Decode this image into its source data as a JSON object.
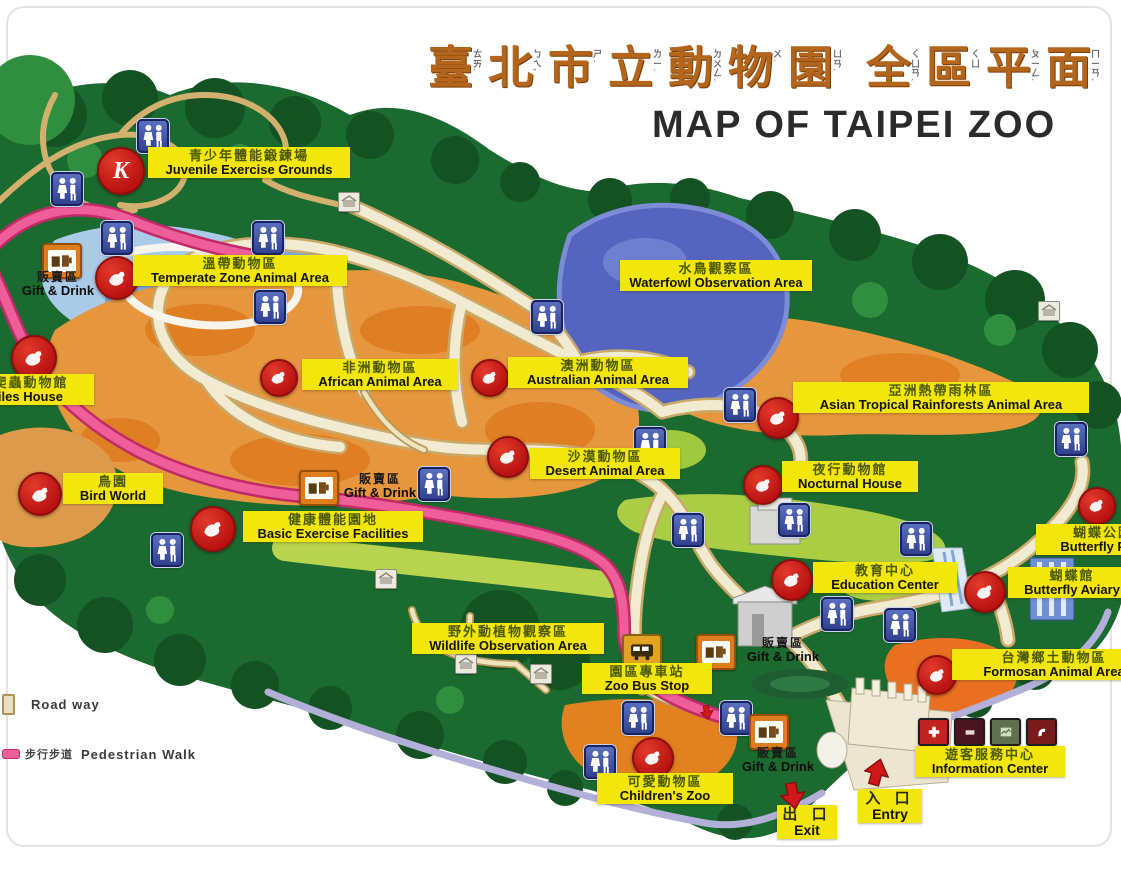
{
  "title": {
    "chars": [
      {
        "c": "臺",
        "z": "ㄊㄞˊ"
      },
      {
        "c": "北",
        "z": "ㄅㄟˇ"
      },
      {
        "c": "市",
        "z": "ㄕˋ"
      },
      {
        "c": "立",
        "z": "ㄌㄧˋ"
      },
      {
        "c": "動",
        "z": "ㄉㄨㄥˋ"
      },
      {
        "c": "物",
        "z": "ㄨˋ"
      },
      {
        "c": "園",
        "z": "ㄩㄢˊ"
      },
      {
        "c": "全",
        "z": "ㄑㄩㄢˊ",
        "gap": true
      },
      {
        "c": "區",
        "z": "ㄑㄩ"
      },
      {
        "c": "平",
        "z": "ㄆㄧㄥˊ"
      },
      {
        "c": "面",
        "z": "ㄇㄧㄢˋ"
      }
    ],
    "en": "MAP OF TAIPEI ZOO"
  },
  "legend": {
    "road_way_en": "Road way",
    "pedestrian_zh": "步行步道",
    "pedestrian_en": "Pedestrian Walk"
  },
  "map": {
    "area_labels": [
      {
        "name": "juvenile-exercise-grounds",
        "zh": "青少年體能鍛鍊場",
        "en": "Juvenile Exercise Grounds",
        "x": 148,
        "y": 147,
        "w": 198
      },
      {
        "name": "temperate-zone-animal-area",
        "zh": "溫帶動物區",
        "en": "Temperate Zone Animal Area",
        "x": 133,
        "y": 255,
        "w": 210
      },
      {
        "name": "waterfowl-observation-area",
        "zh": "水鳥觀察區",
        "en": "Waterfowl Observation Area",
        "x": 620,
        "y": 260,
        "w": 188
      },
      {
        "name": "african-animal-area",
        "zh": "非洲動物區",
        "en": "African Animal Area",
        "x": 302,
        "y": 359,
        "w": 152
      },
      {
        "name": "australian-animal-area",
        "zh": "澳洲動物區",
        "en": "Australian Animal Area",
        "x": 508,
        "y": 357,
        "w": 176
      },
      {
        "name": "asian-tropical-rainforests-animal-area",
        "zh": "亞洲熱帶雨林區",
        "en": "Asian Tropical Rainforests Animal Area",
        "x": 793,
        "y": 382,
        "w": 292
      },
      {
        "name": "desert-animal-area",
        "zh": "沙漠動物區",
        "en": "Desert Animal Area",
        "x": 530,
        "y": 448,
        "w": 146
      },
      {
        "name": "nocturnal-house",
        "zh": "夜行動物館",
        "en": "Nocturnal House",
        "x": 782,
        "y": 461,
        "w": 132
      },
      {
        "name": "reptiles-house",
        "zh": "兩棲爬蟲動物館",
        "en": "Reptiles House",
        "x": -62,
        "y": 374,
        "w": 152
      },
      {
        "name": "bird-world",
        "zh": "鳥園",
        "en": "Bird World",
        "x": 63,
        "y": 473,
        "w": 96
      },
      {
        "name": "basic-exercise-facilities",
        "zh": "健康體能園地",
        "en": "Basic Exercise Facilities",
        "x": 243,
        "y": 511,
        "w": 176
      },
      {
        "name": "butterfly-park",
        "zh": "蝴蝶公園",
        "en": "Butterfly Park",
        "x": 1036,
        "y": 524,
        "w": 130
      },
      {
        "name": "butterfly-aviary",
        "zh": "蝴蝶館",
        "en": "Butterfly Aviary",
        "x": 1008,
        "y": 567,
        "w": 124
      },
      {
        "name": "education-center",
        "zh": "教育中心",
        "en": "Education Center",
        "x": 813,
        "y": 562,
        "w": 140
      },
      {
        "name": "wildlife-observation-area",
        "zh": "野外動植物觀察區",
        "en": "Wildlife Observation Area",
        "x": 412,
        "y": 623,
        "w": 188
      },
      {
        "name": "zoo-bus-stop",
        "zh": "園區專車站",
        "en": "Zoo Bus Stop",
        "x": 582,
        "y": 663,
        "w": 126
      },
      {
        "name": "formosan-animal-area",
        "zh": "台灣鄉土動物區",
        "en": "Formosan Animal Area",
        "x": 952,
        "y": 649,
        "w": 200
      },
      {
        "name": "information-center",
        "zh": "遊客服務中心",
        "en": "Information Center",
        "x": 915,
        "y": 746,
        "w": 146
      },
      {
        "name": "childrens-zoo",
        "zh": "可愛動物區",
        "en": "Children's Zoo",
        "x": 597,
        "y": 773,
        "w": 132
      }
    ],
    "gift_drink": {
      "zh": "販賣區",
      "en": "Gift & Drink",
      "spots": [
        {
          "x": 8,
          "y": 271,
          "w": 100
        },
        {
          "x": 330,
          "y": 473,
          "w": 100
        },
        {
          "x": 733,
          "y": 637,
          "w": 100
        },
        {
          "x": 726,
          "y": 747,
          "w": 104
        }
      ]
    },
    "gates": {
      "exit": {
        "zh": "出 口",
        "en": "Exit",
        "x": 777,
        "y": 805,
        "w": 56
      },
      "entry": {
        "zh": "入 口",
        "en": "Entry",
        "x": 858,
        "y": 789,
        "w": 60
      }
    },
    "red_icons": [
      {
        "name": "juvenile-exercise-icon",
        "x": 119,
        "y": 169,
        "d": 44,
        "glyph": "K"
      },
      {
        "name": "temperate-zone-animal-icon",
        "x": 115,
        "y": 276,
        "d": 40
      },
      {
        "name": "reptiles-icon",
        "x": 32,
        "y": 356,
        "d": 42
      },
      {
        "name": "bird-world-icon",
        "x": 38,
        "y": 492,
        "d": 40
      },
      {
        "name": "african-animal-icon",
        "x": 277,
        "y": 376,
        "d": 34
      },
      {
        "name": "australian-animal-icon",
        "x": 488,
        "y": 376,
        "d": 34
      },
      {
        "name": "desert-animal-icon",
        "x": 506,
        "y": 455,
        "d": 38
      },
      {
        "name": "basic-exercise-icon",
        "x": 211,
        "y": 527,
        "d": 42
      },
      {
        "name": "asian-tropical-icon",
        "x": 776,
        "y": 416,
        "d": 38
      },
      {
        "name": "nocturnal-house-icon",
        "x": 761,
        "y": 483,
        "d": 36
      },
      {
        "name": "education-center-icon",
        "x": 790,
        "y": 578,
        "d": 38
      },
      {
        "name": "butterfly-park-icon",
        "x": 1095,
        "y": 504,
        "d": 34
      },
      {
        "name": "butterfly-aviary-icon",
        "x": 983,
        "y": 590,
        "d": 38
      },
      {
        "name": "formosan-animal-icon",
        "x": 935,
        "y": 673,
        "d": 36
      },
      {
        "name": "childrens-zoo-icon",
        "x": 651,
        "y": 756,
        "d": 38
      }
    ],
    "restroom_icons": [
      [
        151,
        134
      ],
      [
        65,
        187
      ],
      [
        115,
        236
      ],
      [
        266,
        236
      ],
      [
        268,
        305
      ],
      [
        545,
        315
      ],
      [
        738,
        403
      ],
      [
        648,
        442
      ],
      [
        432,
        482
      ],
      [
        1069,
        437
      ],
      [
        686,
        528
      ],
      [
        792,
        518
      ],
      [
        914,
        537
      ],
      [
        165,
        548
      ],
      [
        835,
        612
      ],
      [
        898,
        623
      ],
      [
        636,
        716
      ],
      [
        734,
        716
      ],
      [
        598,
        760
      ]
    ],
    "gift_icons": [
      [
        60,
        259
      ],
      [
        317,
        486
      ],
      [
        714,
        650
      ],
      [
        767,
        730
      ]
    ],
    "facility_icons": [
      [
        348,
        201
      ],
      [
        1048,
        310
      ],
      [
        385,
        578
      ],
      [
        465,
        663
      ],
      [
        540,
        673
      ]
    ],
    "bus_icon": [
      640,
      649
    ],
    "info_icons": {
      "x": 918,
      "y": 718,
      "items": [
        {
          "name": "first-aid-icon",
          "bg": "#c32222"
        },
        {
          "name": "lost-and-found-icon",
          "bg": "#4a1420"
        },
        {
          "name": "map-board-icon",
          "bg": "#5f7050"
        },
        {
          "name": "telephone-icon",
          "bg": "#7a1a1a"
        }
      ]
    },
    "arrows": [
      {
        "name": "exit-arrow",
        "x": 793,
        "y": 796,
        "dir": "down",
        "s": 1.0
      },
      {
        "name": "entry-arrow",
        "x": 877,
        "y": 772,
        "dir": "up",
        "s": 1.0
      },
      {
        "name": "path-arrow",
        "x": 707,
        "y": 712,
        "dir": "down",
        "s": 0.55
      }
    ]
  },
  "palette": {
    "forest": "#1b6a2f",
    "forest_dark": "#145223",
    "orange_area": "#e6963d",
    "orange_deep": "#dd7a1e",
    "lake": "#5565bf",
    "temperate_blue": "#a9cbe8",
    "light_green": "#aace44",
    "road": "#f1ebd1",
    "road_edge": "#c9a869",
    "pedestrian_pink": "#ee5f9a",
    "street_lavender": "#b2afd9",
    "label_yellow": "#f2e60a",
    "icon_red": "#c21818",
    "icon_blue": "#3d52ae",
    "gift_orange": "#de7d1e"
  }
}
